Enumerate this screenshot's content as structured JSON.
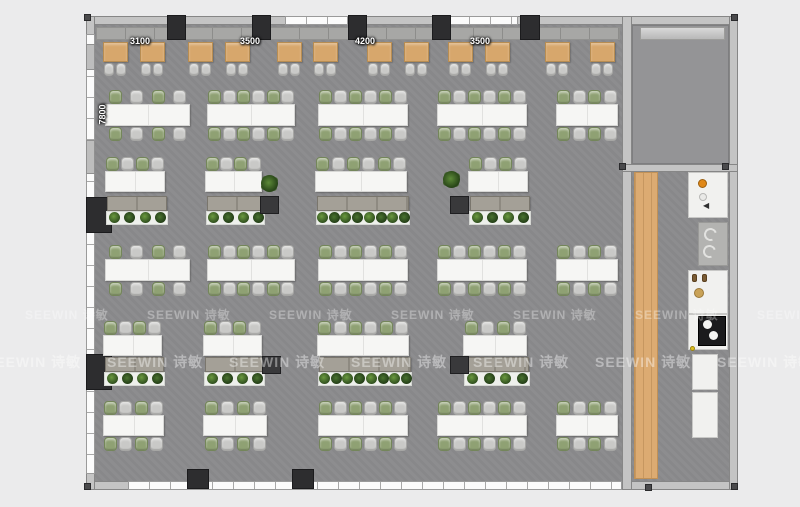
{
  "page": {
    "background": "#ebebec"
  },
  "watermark": {
    "text": "SEEWIN 诗敏",
    "rows": [
      {
        "y": 306,
        "size": 12,
        "opacity": 0.32,
        "xs": [
          25,
          147,
          269,
          391,
          513,
          635,
          757
        ]
      },
      {
        "y": 352,
        "size": 14,
        "opacity": 0.4,
        "xs": [
          -15,
          107,
          229,
          351,
          473,
          595,
          717
        ]
      }
    ]
  },
  "dimensions": {
    "top_y": 36,
    "top": [
      {
        "label": "3100",
        "cx": 140
      },
      {
        "label": "3500",
        "cx": 250
      },
      {
        "label": "4200",
        "cx": 365
      },
      {
        "label": "3500",
        "cx": 480
      }
    ],
    "side": {
      "label": "7800",
      "cx": 103,
      "cy": 114
    }
  },
  "palette": {
    "floor": "#8b8b8d",
    "wall": "#c4c4c4",
    "column": "#2d2d2f",
    "booth": "#d7a76c",
    "chair_green": "#8fa173",
    "chair_gray": "#c9c9c7",
    "table": "#f6f6f4",
    "cabinet": "#a4a097",
    "plant": "#2f4e1e",
    "wood": "#dcab72",
    "accent_orange": "#e08818"
  },
  "plan": {
    "floors": [
      {
        "x": 95,
        "y": 25,
        "w": 527,
        "h": 456,
        "cls": "floor-main",
        "name": "main-office-floor"
      },
      {
        "x": 632,
        "y": 172,
        "w": 97,
        "h": 309,
        "cls": "floor-main",
        "name": "pantry-corridor-floor"
      },
      {
        "x": 632,
        "y": 25,
        "w": 97,
        "h": 139,
        "cls": "floor-room",
        "name": "meeting-room-floor"
      }
    ],
    "walls": [
      [
        86,
        16,
        652,
        9
      ],
      [
        86,
        481,
        652,
        9
      ],
      [
        86,
        16,
        9,
        474
      ],
      [
        729,
        16,
        9,
        474
      ],
      [
        622,
        16,
        10,
        474
      ],
      [
        622,
        164,
        116,
        8
      ]
    ],
    "windows": [
      {
        "x": 86,
        "y": 34,
        "w": 9,
        "h": 440,
        "dir": "v"
      },
      {
        "x": 285,
        "y": 16,
        "w": 63,
        "h": 9,
        "dir": "h"
      },
      {
        "x": 448,
        "y": 16,
        "w": 70,
        "h": 9,
        "dir": "h"
      },
      {
        "x": 128,
        "y": 481,
        "w": 494,
        "h": 9,
        "dir": "h"
      }
    ],
    "wall_segs": [
      [
        86,
        44,
        9,
        26
      ],
      [
        86,
        140,
        9,
        34
      ]
    ],
    "columns": [
      [
        167,
        15,
        19,
        25
      ],
      [
        252,
        15,
        19,
        25
      ],
      [
        348,
        15,
        19,
        25
      ],
      [
        432,
        15,
        19,
        25
      ],
      [
        520,
        15,
        20,
        25
      ],
      [
        187,
        469,
        22,
        20
      ],
      [
        292,
        469,
        22,
        20
      ],
      [
        86,
        197,
        26,
        36
      ],
      [
        86,
        354,
        26,
        36
      ]
    ],
    "dots": [
      [
        84,
        14
      ],
      [
        731,
        14
      ],
      [
        84,
        483
      ],
      [
        731,
        483
      ],
      [
        619,
        163
      ],
      [
        722,
        163
      ],
      [
        645,
        484
      ]
    ],
    "bench": [
      96,
      27,
      524,
      13
    ],
    "wood": [
      634,
      172,
      24,
      307
    ],
    "board": [
      640,
      27,
      85,
      13
    ],
    "booths": {
      "tableY": 42,
      "tableW": 25,
      "tableH": 20,
      "chairY": 63,
      "xs": [
        103,
        140,
        188,
        225,
        277,
        313,
        367,
        404,
        448,
        485,
        545,
        590
      ]
    },
    "table_rows": [
      {
        "chairTopY": 90,
        "tableY": 104,
        "tableH": 22,
        "chairBotY": 127,
        "groups": [
          [
            105,
            85,
            4
          ],
          [
            207,
            88,
            6
          ],
          [
            318,
            90,
            6
          ],
          [
            437,
            90,
            6
          ],
          [
            556,
            62,
            4
          ]
        ]
      },
      {
        "chairTopY": 245,
        "tableY": 259,
        "tableH": 22,
        "chairBotY": 282,
        "groups": [
          [
            105,
            85,
            4
          ],
          [
            207,
            88,
            6
          ],
          [
            318,
            90,
            6
          ],
          [
            437,
            90,
            6
          ],
          [
            556,
            62,
            4
          ]
        ]
      },
      {
        "chairTopY": 401,
        "tableY": 415,
        "tableH": 21,
        "chairBotY": 437,
        "groups": [
          [
            103,
            61,
            4
          ],
          [
            203,
            64,
            4
          ],
          [
            318,
            90,
            6
          ],
          [
            437,
            90,
            6
          ],
          [
            556,
            62,
            4
          ]
        ]
      }
    ],
    "desk_rows": [
      {
        "chairY": 157,
        "deskY": 171,
        "deskH": 21,
        "cabY": 196,
        "cabH": 15,
        "plantY": 211,
        "plantH": 14,
        "groups": [
          [
            105,
            60,
            4,
            4
          ],
          [
            205,
            57,
            4,
            4
          ],
          [
            315,
            92,
            6,
            8
          ],
          [
            468,
            60,
            4,
            4
          ]
        ],
        "darkCabinets": [
          [
            260,
            196
          ],
          [
            450,
            196
          ]
        ],
        "loosePlants": [
          [
            261,
            175
          ],
          [
            443,
            171
          ]
        ]
      },
      {
        "chairY": 321,
        "deskY": 335,
        "deskH": 21,
        "cabY": 357,
        "cabH": 15,
        "plantY": 372,
        "plantH": 14,
        "groups": [
          [
            103,
            59,
            4,
            4
          ],
          [
            203,
            59,
            4,
            4
          ],
          [
            317,
            92,
            6,
            8
          ],
          [
            463,
            64,
            4,
            4
          ]
        ],
        "darkCabinets": [
          [
            262,
            356
          ],
          [
            450,
            356
          ]
        ],
        "loosePlants": []
      }
    ],
    "kitchen": {
      "counters": [
        [
          688,
          172,
          40,
          46
        ],
        [
          688,
          270,
          40,
          44
        ],
        [
          688,
          314,
          40,
          36
        ],
        [
          692,
          354,
          26,
          36
        ],
        [
          692,
          392,
          26,
          46
        ]
      ],
      "fixture_gray": [
        698,
        222,
        30,
        44
      ],
      "c_arcs": [
        [
          704,
          228
        ],
        [
          703,
          245
        ]
      ],
      "stove": [
        698,
        316,
        28,
        30
      ],
      "burners": [
        [
          703,
          320,
          9
        ],
        [
          709,
          331,
          9
        ]
      ],
      "faucets": [
        [
          692,
          274
        ],
        [
          702,
          274
        ]
      ],
      "dots": [
        {
          "type": "orange",
          "x": 698,
          "y": 179,
          "r": 9
        },
        {
          "type": "plain",
          "x": 699,
          "y": 193,
          "r": 8
        },
        {
          "type": "tan",
          "x": 694,
          "y": 288,
          "r": 10
        },
        {
          "type": "yellow",
          "x": 690,
          "y": 346,
          "r": 5
        }
      ],
      "speaker": [
        703,
        202
      ],
      "speaker_glyph": "◀"
    }
  }
}
